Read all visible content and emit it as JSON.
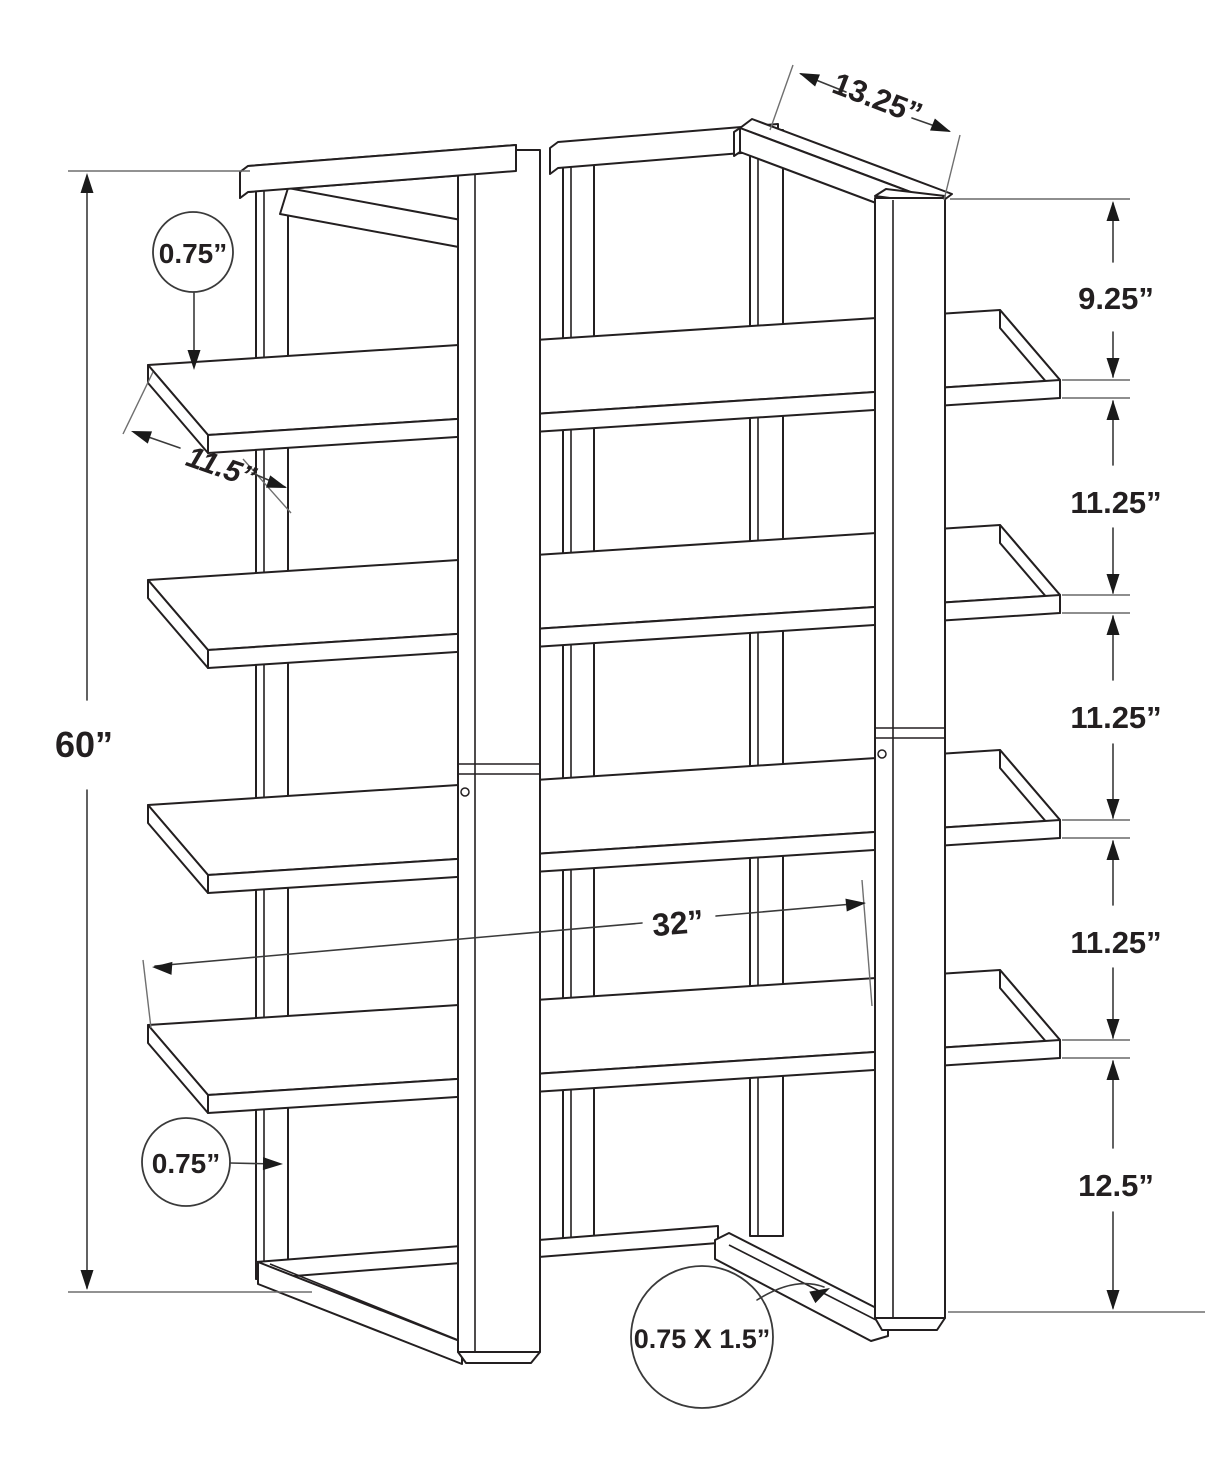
{
  "diagram": {
    "background": "#ffffff",
    "line_color": "#231f20",
    "dimension_color": "#3a3a3a",
    "dimensions": {
      "total_height": "60”",
      "top_depth": "13.25”",
      "top_gap": "9.25”",
      "shelf_gap_1": "11.25”",
      "shelf_gap_2": "11.25”",
      "shelf_gap_3": "11.25”",
      "bottom_gap": "12.5”",
      "shelf_width": "32”",
      "shelf_depth": "11.5”",
      "shelf_thickness": "0.75”",
      "post_thickness": "0.75”",
      "frame_tube_size": "0.75 X 1.5”"
    }
  }
}
